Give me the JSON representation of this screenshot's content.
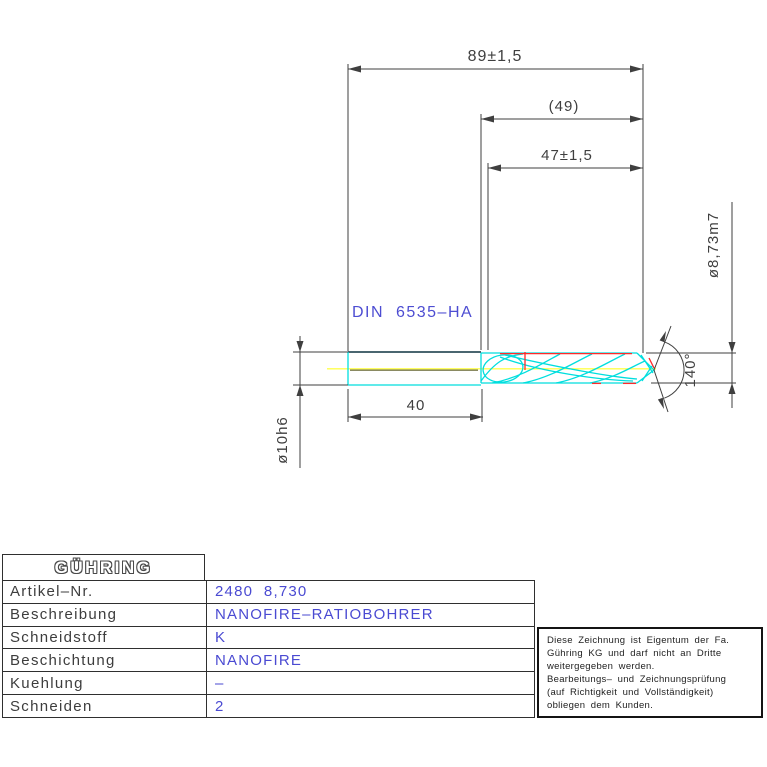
{
  "drawing": {
    "standard_label": "DIN  6535–HA",
    "dimensions": {
      "overall_length": "89±1,5",
      "flute_length_ref": "(49)",
      "flute_length": "47±1,5",
      "shank_length": "40",
      "shank_diameter": "ø10h6",
      "cutting_diameter": "ø8,73m7",
      "point_angle": "140°"
    },
    "colors": {
      "line": "#3f3f3f",
      "accent_blue": "#4a4ad2",
      "tool_cyan": "#00dede",
      "margin_red": "#ff2a2a",
      "centerline_yellow": "#ffff4d",
      "centerline_olive": "#8a8a62"
    }
  },
  "title_block": {
    "logo": "GÜHRING",
    "rows": [
      {
        "label": "Artikel–Nr.",
        "value": "2480  8,730"
      },
      {
        "label": "Beschreibung",
        "value": "NANOFIRE–RATIOBOHRER"
      },
      {
        "label": "Schneidstoff",
        "value": "K"
      },
      {
        "label": "Beschichtung",
        "value": "NANOFIRE"
      },
      {
        "label": "Kuehlung",
        "value": "–"
      },
      {
        "label": "Schneiden",
        "value": "2"
      }
    ]
  },
  "note_box": {
    "lines": [
      "Diese Zeichnung ist Eigentum der Fa.",
      "Gühring KG und darf nicht an Dritte",
      "weitergegeben werden.",
      "Bearbeitungs– und Zeichnungsprüfung",
      "(auf Richtigkeit und Vollständigkeit)",
      "obliegen dem Kunden."
    ]
  }
}
